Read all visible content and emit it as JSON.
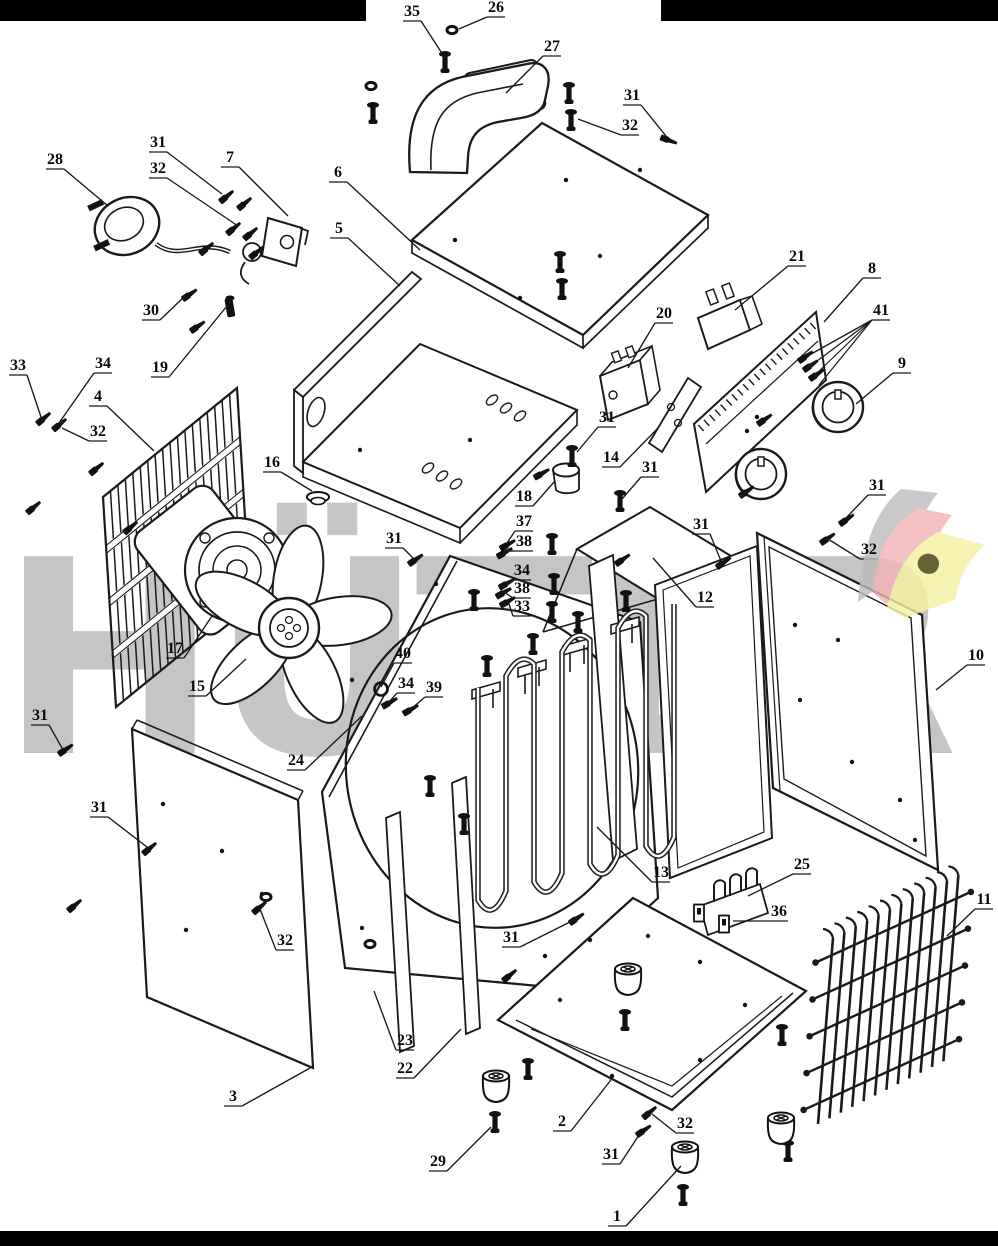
{
  "figure": {
    "type": "exploded-parts-diagram"
  },
  "watermark": {
    "text": "HÜTER",
    "color": "#c5c5c5"
  },
  "brand_logo": {
    "gray": "#bcbcbc",
    "pink": "#f3b3b8",
    "yellow": "#f6f1a2",
    "accent": "#45430c"
  },
  "bars": {
    "color": "#000000"
  },
  "callouts": [
    {
      "n": "35",
      "x": 412,
      "y": 12,
      "tx": 445,
      "ty": 58
    },
    {
      "n": "26",
      "x": 496,
      "y": 8,
      "tx": 459,
      "ty": 29
    },
    {
      "n": "27",
      "x": 552,
      "y": 47,
      "tx": 506,
      "ty": 93
    },
    {
      "n": "31",
      "x": 632,
      "y": 96,
      "tx": 666,
      "ty": 136
    },
    {
      "n": "32",
      "x": 630,
      "y": 126,
      "tx": 578,
      "ty": 119
    },
    {
      "n": "6",
      "x": 338,
      "y": 173,
      "tx": 420,
      "ty": 250
    },
    {
      "n": "28",
      "x": 55,
      "y": 160,
      "tx": 108,
      "ty": 206
    },
    {
      "n": "31",
      "x": 158,
      "y": 143,
      "tx": 222,
      "ty": 194
    },
    {
      "n": "32",
      "x": 158,
      "y": 169,
      "tx": 238,
      "ty": 226
    },
    {
      "n": "7",
      "x": 230,
      "y": 158,
      "tx": 288,
      "ty": 216
    },
    {
      "n": "5",
      "x": 339,
      "y": 229,
      "tx": 400,
      "ty": 286
    },
    {
      "n": "30",
      "x": 151,
      "y": 311,
      "tx": 185,
      "ty": 296
    },
    {
      "n": "19",
      "x": 160,
      "y": 368,
      "tx": 227,
      "ty": 306
    },
    {
      "n": "33",
      "x": 18,
      "y": 366,
      "tx": 41,
      "ty": 417
    },
    {
      "n": "34",
      "x": 103,
      "y": 364,
      "tx": 59,
      "ty": 423
    },
    {
      "n": "32",
      "x": 98,
      "y": 432,
      "tx": 62,
      "ty": 428
    },
    {
      "n": "4",
      "x": 98,
      "y": 397,
      "tx": 154,
      "ty": 451
    },
    {
      "n": "21",
      "x": 797,
      "y": 257,
      "tx": 735,
      "ty": 310
    },
    {
      "n": "8",
      "x": 872,
      "y": 269,
      "tx": 824,
      "ty": 322
    },
    {
      "n": "41",
      "x": 881,
      "y": 311,
      "tx": 804,
      "ty": 358,
      "extra": [
        [
          809,
          367
        ],
        [
          814,
          376
        ],
        [
          819,
          385
        ]
      ]
    },
    {
      "n": "9",
      "x": 902,
      "y": 364,
      "tx": 856,
      "ty": 404
    },
    {
      "n": "20",
      "x": 664,
      "y": 314,
      "tx": 628,
      "ty": 368
    },
    {
      "n": "14",
      "x": 611,
      "y": 458,
      "tx": 658,
      "ty": 428
    },
    {
      "n": "31",
      "x": 607,
      "y": 418,
      "tx": 577,
      "ty": 452
    },
    {
      "n": "18",
      "x": 524,
      "y": 497,
      "tx": 554,
      "ty": 482
    },
    {
      "n": "31",
      "x": 650,
      "y": 468,
      "tx": 622,
      "ty": 499
    },
    {
      "n": "37",
      "x": 524,
      "y": 522,
      "tx": 507,
      "ty": 543
    },
    {
      "n": "38",
      "x": 524,
      "y": 542,
      "tx": 505,
      "ty": 551
    },
    {
      "n": "34",
      "x": 522,
      "y": 571,
      "tx": 506,
      "ty": 583
    },
    {
      "n": "38",
      "x": 522,
      "y": 589,
      "tx": 504,
      "ty": 592
    },
    {
      "n": "33",
      "x": 522,
      "y": 607,
      "tx": 508,
      "ty": 601
    },
    {
      "n": "12",
      "x": 705,
      "y": 598,
      "tx": 653,
      "ty": 558
    },
    {
      "n": "31",
      "x": 701,
      "y": 525,
      "tx": 721,
      "ty": 561
    },
    {
      "n": "31",
      "x": 877,
      "y": 486,
      "tx": 846,
      "ty": 518
    },
    {
      "n": "32",
      "x": 869,
      "y": 550,
      "tx": 828,
      "ty": 539
    },
    {
      "n": "10",
      "x": 976,
      "y": 656,
      "tx": 936,
      "ty": 690
    },
    {
      "n": "16",
      "x": 272,
      "y": 463,
      "tx": 312,
      "ty": 491
    },
    {
      "n": "17",
      "x": 175,
      "y": 649,
      "tx": 212,
      "ty": 616
    },
    {
      "n": "15",
      "x": 197,
      "y": 687,
      "tx": 246,
      "ty": 659
    },
    {
      "n": "31",
      "x": 394,
      "y": 539,
      "tx": 414,
      "ty": 559
    },
    {
      "n": "40",
      "x": 403,
      "y": 654,
      "tx": 381,
      "ty": 687
    },
    {
      "n": "34",
      "x": 406,
      "y": 684,
      "tx": 390,
      "ty": 701
    },
    {
      "n": "39",
      "x": 434,
      "y": 688,
      "tx": 411,
      "ty": 709
    },
    {
      "n": "24",
      "x": 296,
      "y": 761,
      "tx": 362,
      "ty": 716
    },
    {
      "n": "31",
      "x": 40,
      "y": 716,
      "tx": 62,
      "ty": 748
    },
    {
      "n": "31",
      "x": 99,
      "y": 808,
      "tx": 147,
      "ty": 847
    },
    {
      "n": "32",
      "x": 285,
      "y": 941,
      "tx": 260,
      "ty": 909
    },
    {
      "n": "3",
      "x": 233,
      "y": 1097,
      "tx": 310,
      "ty": 1068
    },
    {
      "n": "23",
      "x": 405,
      "y": 1041,
      "tx": 374,
      "ty": 991
    },
    {
      "n": "22",
      "x": 405,
      "y": 1069,
      "tx": 461,
      "ty": 1029
    },
    {
      "n": "13",
      "x": 661,
      "y": 873,
      "tx": 597,
      "ty": 827
    },
    {
      "n": "31",
      "x": 511,
      "y": 938,
      "tx": 574,
      "ty": 920
    },
    {
      "n": "25",
      "x": 802,
      "y": 865,
      "tx": 748,
      "ty": 896
    },
    {
      "n": "36",
      "x": 779,
      "y": 912,
      "tx": 733,
      "ty": 921
    },
    {
      "n": "11",
      "x": 984,
      "y": 900,
      "tx": 947,
      "ty": 936
    },
    {
      "n": "2",
      "x": 562,
      "y": 1122,
      "tx": 614,
      "ty": 1076
    },
    {
      "n": "31",
      "x": 611,
      "y": 1155,
      "tx": 641,
      "ty": 1132
    },
    {
      "n": "32",
      "x": 685,
      "y": 1124,
      "tx": 652,
      "ty": 1114
    },
    {
      "n": "29",
      "x": 438,
      "y": 1162,
      "tx": 491,
      "ty": 1127
    },
    {
      "n": "1",
      "x": 617,
      "y": 1217,
      "tx": 681,
      "ty": 1166
    }
  ],
  "hardware": {
    "screws": [
      [
        226,
        197,
        -40
      ],
      [
        244,
        204,
        -40
      ],
      [
        233,
        229,
        -40
      ],
      [
        250,
        234,
        -40
      ],
      [
        206,
        249,
        -40
      ],
      [
        256,
        253,
        -40
      ],
      [
        189,
        295,
        -35
      ],
      [
        197,
        327,
        -35
      ],
      [
        43,
        419,
        -40
      ],
      [
        59,
        425,
        -40
      ],
      [
        96,
        469,
        -40
      ],
      [
        33,
        508,
        -40
      ],
      [
        130,
        528,
        -40
      ],
      [
        668,
        140,
        20
      ],
      [
        415,
        560,
        -35
      ],
      [
        723,
        563,
        -35
      ],
      [
        846,
        520,
        -35
      ],
      [
        827,
        539,
        -35
      ],
      [
        507,
        545,
        -30
      ],
      [
        504,
        553,
        -30
      ],
      [
        506,
        584,
        -30
      ],
      [
        503,
        593,
        -30
      ],
      [
        507,
        602,
        -30
      ],
      [
        389,
        703,
        -30
      ],
      [
        410,
        710,
        -30
      ],
      [
        65,
        750,
        -35
      ],
      [
        149,
        849,
        -40
      ],
      [
        74,
        906,
        -40
      ],
      [
        259,
        908,
        -40
      ],
      [
        576,
        919,
        -35
      ],
      [
        509,
        976,
        -40
      ],
      [
        643,
        1131,
        -35
      ],
      [
        649,
        1113,
        -40
      ],
      [
        805,
        357,
        -35
      ],
      [
        810,
        366,
        -35
      ],
      [
        816,
        375,
        -35
      ],
      [
        764,
        420,
        -35
      ],
      [
        746,
        492,
        -35
      ],
      [
        541,
        474,
        -30
      ],
      [
        622,
        560,
        -35
      ]
    ],
    "nuts": [
      [
        452,
        30
      ],
      [
        371,
        86
      ],
      [
        266,
        897
      ],
      [
        370,
        944
      ]
    ],
    "vbolts": [
      [
        445,
        64
      ],
      [
        373,
        115
      ],
      [
        569,
        95
      ],
      [
        571,
        122
      ],
      [
        560,
        264
      ],
      [
        562,
        291
      ],
      [
        572,
        458
      ],
      [
        620,
        503
      ],
      [
        552,
        546
      ],
      [
        554,
        586
      ],
      [
        552,
        614
      ],
      [
        474,
        602
      ],
      [
        430,
        788
      ],
      [
        464,
        826
      ],
      [
        487,
        668
      ],
      [
        533,
        646
      ],
      [
        578,
        624
      ],
      [
        626,
        603
      ],
      [
        495,
        1124
      ],
      [
        625,
        1022
      ],
      [
        528,
        1071
      ],
      [
        683,
        1197
      ],
      [
        788,
        1153
      ],
      [
        782,
        1037
      ]
    ],
    "washers": [
      [
        381,
        689
      ]
    ],
    "grommets": [
      [
        318,
        497
      ]
    ],
    "locks": [
      [
        230,
        308
      ]
    ],
    "clips": [
      [
        699,
        913
      ],
      [
        724,
        924
      ]
    ],
    "feet": [
      [
        628,
        982
      ],
      [
        496,
        1089
      ],
      [
        685,
        1160
      ],
      [
        781,
        1131
      ]
    ],
    "dots": [
      [
        455,
        240
      ],
      [
        520,
        298
      ],
      [
        600,
        256
      ],
      [
        640,
        170
      ],
      [
        566,
        180
      ],
      [
        470,
        440
      ],
      [
        360,
        450
      ],
      [
        436,
        584
      ],
      [
        352,
        680
      ],
      [
        362,
        928
      ],
      [
        545,
        956
      ],
      [
        795,
        625
      ],
      [
        838,
        640
      ],
      [
        800,
        700
      ],
      [
        852,
        762
      ],
      [
        900,
        800
      ],
      [
        915,
        840
      ],
      [
        163,
        804
      ],
      [
        222,
        851
      ],
      [
        262,
        894
      ],
      [
        186,
        930
      ],
      [
        590,
        940
      ],
      [
        648,
        936
      ],
      [
        700,
        962
      ],
      [
        745,
        1005
      ],
      [
        700,
        1060
      ],
      [
        560,
        1000
      ],
      [
        612,
        1076
      ],
      [
        747,
        431
      ],
      [
        757,
        417
      ]
    ]
  },
  "gen": {
    "grill4": {
      "tl": [
        103,
        497
      ],
      "tr": [
        237,
        388
      ],
      "dv": [
        13,
        210
      ],
      "n": 18,
      "bands": [
        0.25,
        0.5,
        0.75
      ]
    },
    "grill11": {
      "top": [
        833,
        938
      ],
      "step": [
        11.4,
        -5.7
      ],
      "n": 12,
      "drop": [
        -15,
        186
      ],
      "rods": 5
    },
    "coil": {
      "x0": 478,
      "dx": 28,
      "n": 8,
      "top": 688,
      "ts": -12,
      "bot": 900,
      "bs": -9
    },
    "ticks8": {
      "a": [
        701,
        428
      ],
      "b": [
        813,
        326
      ],
      "n": 20
    },
    "hangers": [
      [
        487,
        690
      ],
      [
        533,
        668
      ],
      [
        578,
        646
      ],
      [
        626,
        625
      ]
    ]
  }
}
